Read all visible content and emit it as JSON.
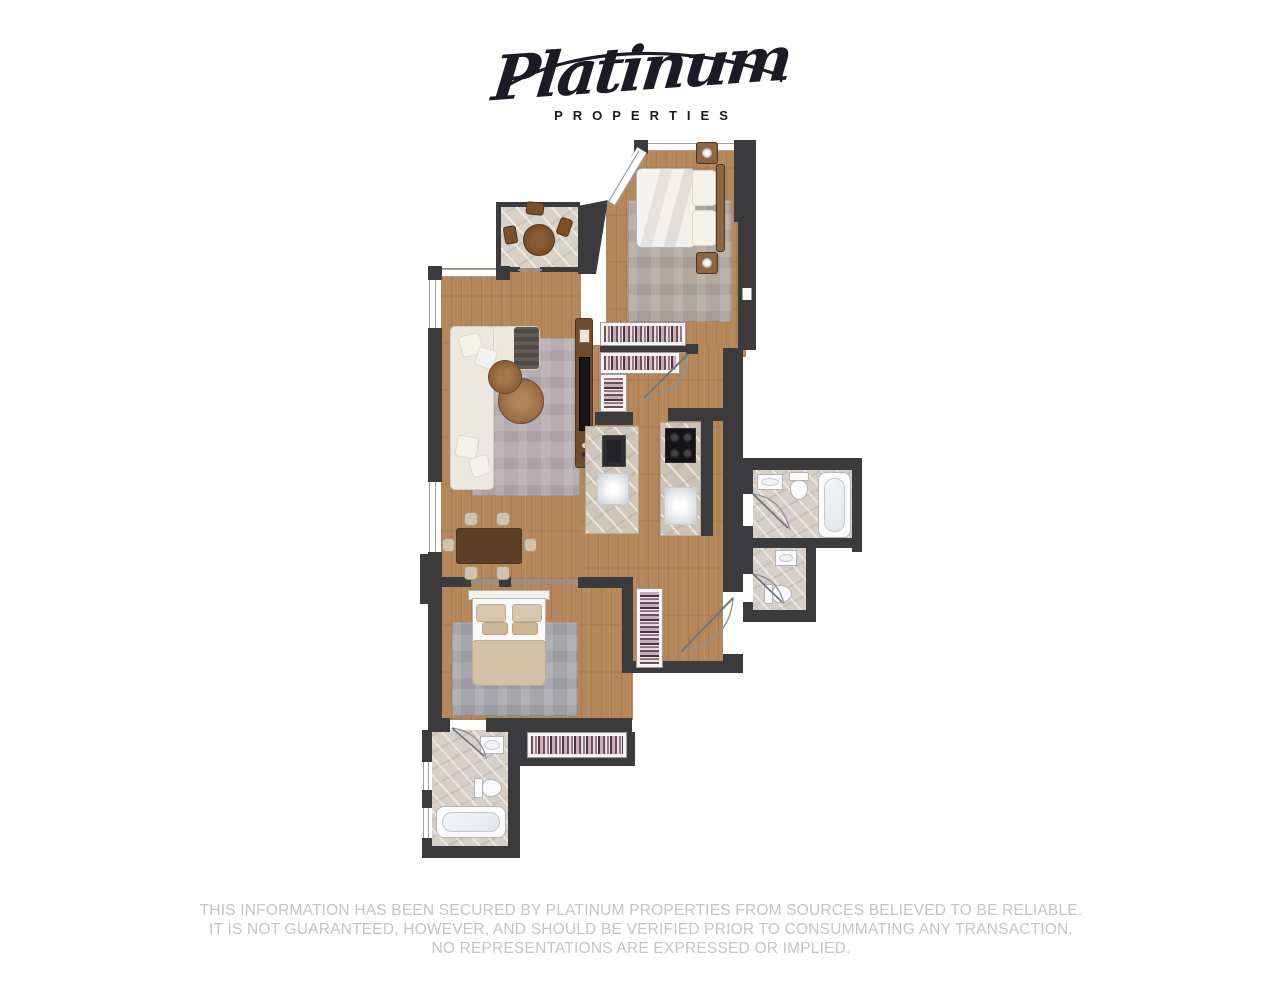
{
  "brand": {
    "name": "Platinum",
    "tagline": "PROPERTIES"
  },
  "disclaimer": {
    "lines": [
      "THIS INFORMATION HAS BEEN SECURED BY PLATINUM PROPERTIES FROM SOURCES BELIEVED TO BE RELIABLE.",
      "IT IS NOT GUARANTEED, HOWEVER, AND SHOULD BE VERIFIED PRIOR TO CONSUMMATING ANY TRANSACTION.",
      "NO REPRESENTATIONS ARE EXPRESSED OR IMPLIED."
    ]
  },
  "colors": {
    "wall": "#3b3b3d",
    "wood": "#b6875a",
    "marble": "#d8d1c7",
    "tile": "#d6cfc7",
    "rug_warm": "#b3a89e",
    "rug_gray": "#b5adb0",
    "rug_blue": "#a6a7ac",
    "sofa": "#ebe8e2",
    "bed_white": "#efedea",
    "bed_tan": "#d5c1a7",
    "furniture_wood": "#6f4a2c",
    "fixture": "#fbfbfb",
    "fixture_line": "#b5b5b8",
    "door": "#8e939b",
    "window": "#9aa0a6",
    "closet_bg": "#f7f5f3",
    "logo": "#1b1b26",
    "disclaimer_text": "#c5c5c7"
  }
}
